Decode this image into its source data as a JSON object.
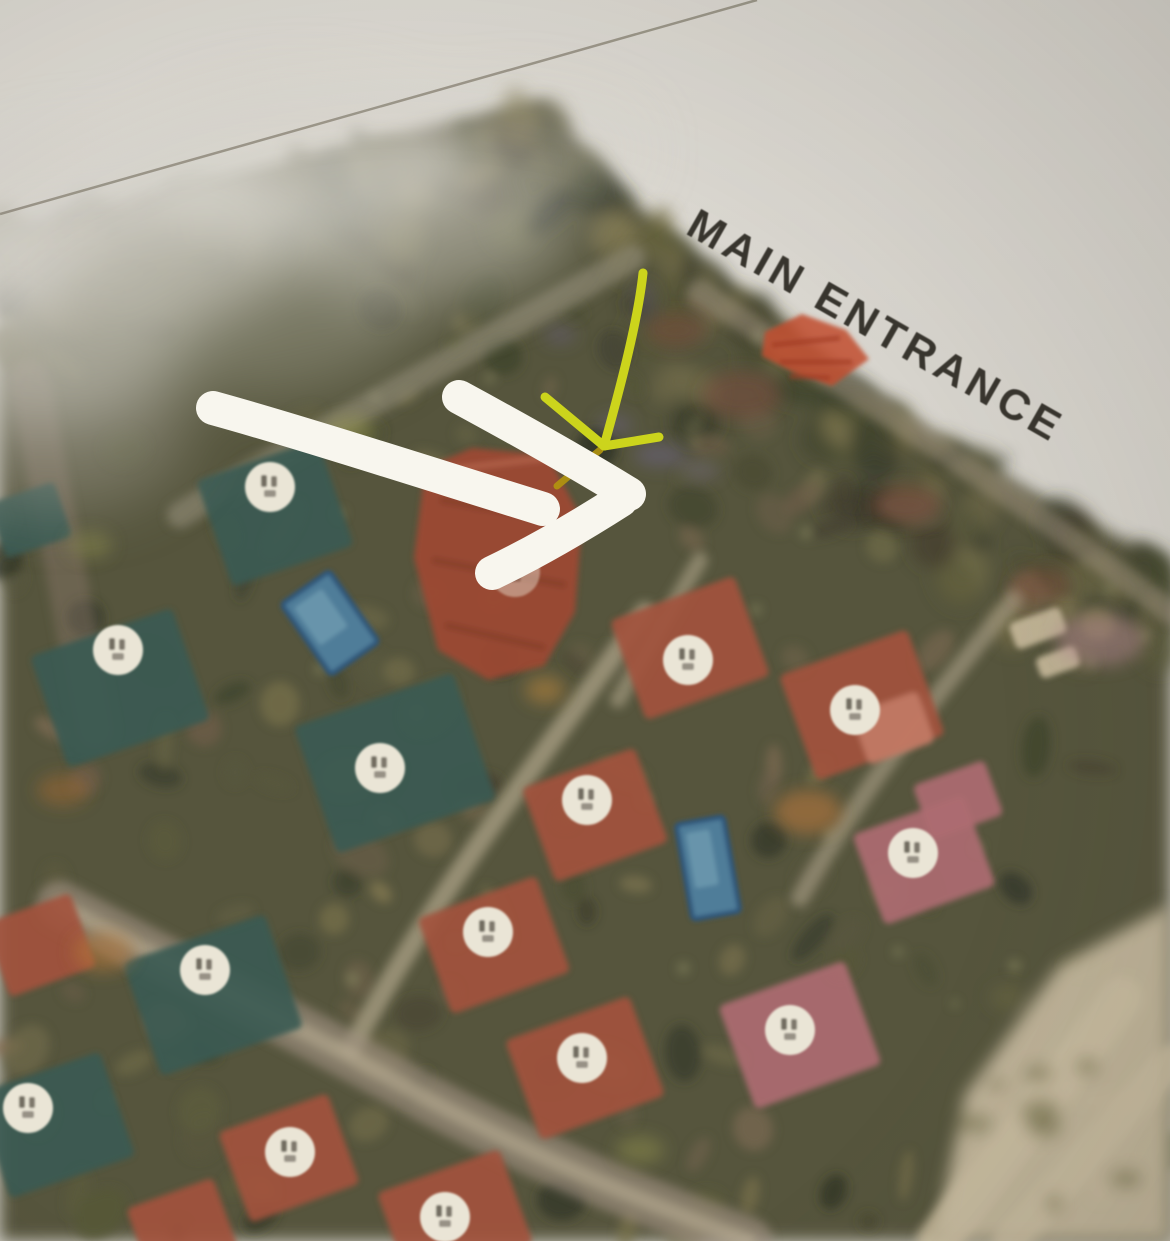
{
  "map": {
    "entrance_label": "MAIN ENTRANCE",
    "palette": {
      "paper": "#d9d6cf",
      "map_base": "#56543d",
      "marker_bg": "#eae5d6",
      "marker_glyph": "#443e33",
      "teal_roof": "#3a5a52",
      "red_roof": "#a2513c",
      "pink_roof": "#ad6b72",
      "salmon_roof": "#c27b66",
      "pool_fill": "#4f7d99",
      "pool_edge": "#2e567a",
      "white_arrow": "#f8f6ee",
      "yellow_arrow": "#ccd41c",
      "yellow_arrow_dark": "#b2950e",
      "entrance_mark": "#c14e2e",
      "label_color": "#38352e",
      "crease": "#8d8779",
      "sand": "#c7bb9f",
      "road_light": "#c2b59a"
    },
    "tree_line": [
      [
        0,
        230
      ],
      [
        545,
        100
      ],
      [
        620,
        190
      ],
      [
        700,
        260
      ],
      [
        790,
        330
      ],
      [
        880,
        400
      ],
      [
        980,
        462
      ],
      [
        1080,
        520
      ],
      [
        1170,
        560
      ]
    ],
    "crease": {
      "x1": 0,
      "y1": 214,
      "x2": 757,
      "y2": 0,
      "width": 2.5
    },
    "entrance_mark": {
      "points": "765,332 802,314 846,330 869,359 832,386 791,371 762,356",
      "streaks": [
        "M772,345L840,338",
        "M780,362L852,362",
        "M790,376L830,378"
      ]
    },
    "big_building": {
      "points": "425,468 472,448 548,455 582,520 575,612 544,666 488,680 438,650 414,558"
    },
    "villas": [
      {
        "kind": "teal",
        "x": 275,
        "y": 513,
        "w": 128,
        "h": 112,
        "rot": -19
      },
      {
        "kind": "teal",
        "x": 120,
        "y": 688,
        "w": 150,
        "h": 118,
        "rot": -19
      },
      {
        "kind": "teal",
        "x": 395,
        "y": 763,
        "w": 168,
        "h": 134,
        "rot": -19
      },
      {
        "kind": "teal",
        "x": 213,
        "y": 995,
        "w": 150,
        "h": 120,
        "rot": -19
      },
      {
        "kind": "teal",
        "x": 55,
        "y": 1125,
        "w": 132,
        "h": 110,
        "rot": -19
      },
      {
        "kind": "teal",
        "x": 30,
        "y": 520,
        "w": 70,
        "h": 58,
        "rot": -19
      },
      {
        "kind": "red",
        "x": 690,
        "y": 648,
        "w": 132,
        "h": 106,
        "rot": -20
      },
      {
        "kind": "red",
        "x": 862,
        "y": 705,
        "w": 136,
        "h": 112,
        "rot": -20
      },
      {
        "kind": "red",
        "x": 595,
        "y": 815,
        "w": 120,
        "h": 100,
        "rot": -20
      },
      {
        "kind": "red",
        "x": 494,
        "y": 945,
        "w": 126,
        "h": 102,
        "rot": -20
      },
      {
        "kind": "red",
        "x": 585,
        "y": 1068,
        "w": 132,
        "h": 106,
        "rot": -20
      },
      {
        "kind": "red",
        "x": 455,
        "y": 1218,
        "w": 130,
        "h": 100,
        "rot": -20
      },
      {
        "kind": "red",
        "x": 289,
        "y": 1158,
        "w": 116,
        "h": 96,
        "rot": -20
      },
      {
        "kind": "red",
        "x": 40,
        "y": 945,
        "w": 92,
        "h": 78,
        "rot": -20
      },
      {
        "kind": "red",
        "x": 182,
        "y": 1228,
        "w": 92,
        "h": 74,
        "rot": -20
      },
      {
        "kind": "pink",
        "x": 924,
        "y": 860,
        "w": 118,
        "h": 96,
        "rot": -20
      },
      {
        "kind": "pink",
        "x": 800,
        "y": 1035,
        "w": 134,
        "h": 110,
        "rot": -20
      },
      {
        "kind": "pink",
        "x": 958,
        "y": 800,
        "w": 76,
        "h": 58,
        "rot": -20
      },
      {
        "kind": "salmon",
        "x": 893,
        "y": 728,
        "w": 70,
        "h": 54,
        "rot": -20
      },
      {
        "kind": "beige",
        "x": 1038,
        "y": 628,
        "w": 54,
        "h": 28,
        "rot": -20
      },
      {
        "kind": "beige",
        "x": 1058,
        "y": 662,
        "w": 42,
        "h": 22,
        "rot": -20
      }
    ],
    "pools": [
      {
        "x": 330,
        "y": 623,
        "w": 58,
        "h": 86,
        "rot": -35
      },
      {
        "x": 708,
        "y": 868,
        "w": 48,
        "h": 96,
        "rot": -10
      }
    ],
    "markers": [
      [
        270,
        487
      ],
      [
        118,
        650
      ],
      [
        380,
        768
      ],
      [
        205,
        970
      ],
      [
        28,
        1108
      ],
      [
        290,
        1152
      ],
      [
        445,
        1217
      ],
      [
        488,
        932
      ],
      [
        582,
        1058
      ],
      [
        587,
        800
      ],
      [
        688,
        660
      ],
      [
        855,
        710
      ],
      [
        913,
        853
      ],
      [
        790,
        1030
      ],
      [
        515,
        572,
        0.45
      ]
    ],
    "roads": [
      {
        "d": "M632,258 C480,345 320,430 180,515",
        "w": 26,
        "c": "#9f9a85",
        "o": 0.5
      },
      {
        "d": "M700,292 C850,392 1000,482 1170,612",
        "w": 24,
        "c": "#ada089",
        "o": 0.45
      },
      {
        "d": "M645,612 C540,760 430,900 352,1048",
        "w": 20,
        "c": "#c2b59a",
        "o": 0.6
      },
      {
        "d": "M60,905 C200,980 310,1032 420,1095 C540,1160 640,1200 748,1241",
        "w": 48,
        "c": "#9c8f7e",
        "o": 0.65
      },
      {
        "d": "M60,905 C200,980 310,1032 420,1095 C540,1160 640,1200 748,1241",
        "w": 16,
        "c": "#c6b99d",
        "o": 0.5
      },
      {
        "d": "M700,560 L618,700",
        "w": 16,
        "c": "#c2b59a",
        "o": 0.5
      },
      {
        "d": "M1015,598 C940,690 860,790 800,898",
        "w": 18,
        "c": "#b5a88f",
        "o": 0.55
      },
      {
        "d": "M938,1241 L1122,998",
        "w": 42,
        "c": "#cfc2a4",
        "o": 0.8
      },
      {
        "d": "M1010,1241 L1170,1062",
        "w": 34,
        "c": "#cfc2a4",
        "o": 0.7
      },
      {
        "d": "M30,380 L95,730",
        "w": 40,
        "c": "#8f7a6e",
        "o": 0.4
      }
    ],
    "sand": {
      "points": "935,1241 965,1095 1060,965 1170,905 1170,1241"
    },
    "accents": [
      {
        "x": 808,
        "y": 812,
        "rx": 34,
        "ry": 22,
        "c": "#b5763a",
        "o": 0.6
      },
      {
        "x": 103,
        "y": 952,
        "rx": 30,
        "ry": 20,
        "c": "#b5763a",
        "o": 0.55
      },
      {
        "x": 63,
        "y": 790,
        "rx": 26,
        "ry": 16,
        "c": "#a06a34",
        "o": 0.5
      },
      {
        "x": 545,
        "y": 690,
        "rx": 20,
        "ry": 14,
        "c": "#c08a3c",
        "o": 0.5
      },
      {
        "x": 350,
        "y": 432,
        "rx": 26,
        "ry": 16,
        "c": "#9a9a50",
        "o": 0.5
      },
      {
        "x": 640,
        "y": 1150,
        "rx": 24,
        "ry": 14,
        "c": "#9a9a50",
        "o": 0.4
      },
      {
        "x": 90,
        "y": 545,
        "rx": 22,
        "ry": 14,
        "c": "#8a8a4a",
        "o": 0.45
      },
      {
        "x": 742,
        "y": 395,
        "rx": 40,
        "ry": 24,
        "c": "#7e493b",
        "o": 0.5
      },
      {
        "x": 676,
        "y": 330,
        "rx": 30,
        "ry": 18,
        "c": "#7e493b",
        "o": 0.45
      },
      {
        "x": 905,
        "y": 505,
        "rx": 36,
        "ry": 20,
        "c": "#8a4f40",
        "o": 0.5
      },
      {
        "x": 1040,
        "y": 585,
        "rx": 30,
        "ry": 18,
        "c": "#8a4f40",
        "o": 0.4
      },
      {
        "x": 1100,
        "y": 640,
        "rx": 45,
        "ry": 26,
        "c": "#b58a92",
        "o": 0.5
      },
      {
        "x": 660,
        "y": 455,
        "rx": 26,
        "ry": 12,
        "c": "#6e6391",
        "o": 0.45
      },
      {
        "x": 615,
        "y": 425,
        "rx": 18,
        "ry": 10,
        "c": "#6e6391",
        "o": 0.4
      },
      {
        "x": 700,
        "y": 470,
        "rx": 20,
        "ry": 10,
        "c": "#7d7099",
        "o": 0.35
      },
      {
        "x": 560,
        "y": 335,
        "rx": 16,
        "ry": 9,
        "c": "#6e6391",
        "o": 0.35
      },
      {
        "x": 645,
        "y": 300,
        "rx": 12,
        "ry": 18,
        "c": "#5f5680",
        "o": 0.3
      }
    ],
    "haze": [
      {
        "x": 110,
        "y": 235,
        "rx": 190,
        "ry": 95,
        "c": "#d9d6cf",
        "o": 0.9
      },
      {
        "x": 300,
        "y": 160,
        "rx": 170,
        "ry": 75,
        "c": "#d9d6cf",
        "o": 0.7
      },
      {
        "x": 40,
        "y": 330,
        "rx": 150,
        "ry": 95,
        "c": "#d9d6cf",
        "o": 0.6
      },
      {
        "x": 230,
        "y": 310,
        "rx": 190,
        "ry": 85,
        "c": "#9a9a88",
        "o": 0.5
      },
      {
        "x": 420,
        "y": 230,
        "rx": 150,
        "ry": 70,
        "c": "#d9d6cf",
        "o": 0.45
      },
      {
        "x": 60,
        "y": 430,
        "rx": 130,
        "ry": 80,
        "c": "#a8a598",
        "o": 0.4
      },
      {
        "x": 520,
        "y": 150,
        "rx": 120,
        "ry": 55,
        "c": "#d9d6cf",
        "o": 0.35
      }
    ],
    "white_arrow": {
      "width": 34,
      "paths": [
        "M213,408 C300,432 430,474 543,509",
        "M459,397 C520,430 580,464 629,494",
        "M492,573 C540,550 585,523 621,500"
      ]
    },
    "yellow_arrow": {
      "width": 9,
      "paths": [
        "M643,273 C638,320 621,385 604,446",
        "M545,397 L604,446",
        "M604,446 L659,437"
      ],
      "extra_path": "M600,450 L557,486"
    }
  }
}
